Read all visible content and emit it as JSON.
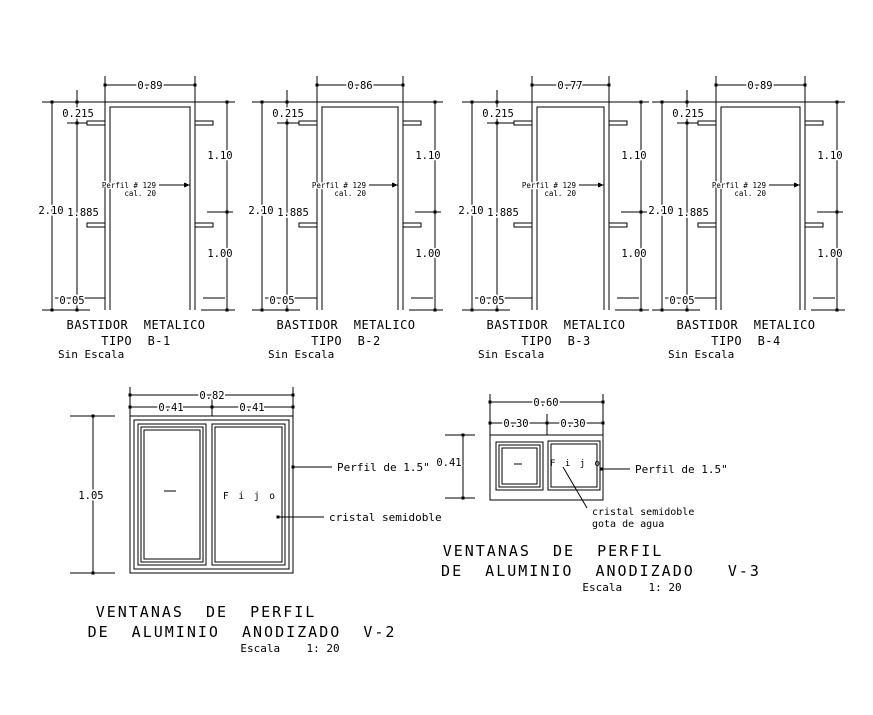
{
  "page": {
    "background": "#ffffff",
    "line_color": "#000000"
  },
  "frames": [
    {
      "top": "0.89",
      "left_offset": "0.215",
      "total_height": "2.10",
      "inner_height": "1.885",
      "floor": "0.05",
      "right_upper": "1.10",
      "right_lower": "1.00",
      "profile_1": "Perfil # 129",
      "profile_2": "cal. 20",
      "title_1": "BASTIDOR  METALICO",
      "title_2": "TIPO  B-1",
      "note": "Sin Escala"
    },
    {
      "top": "0.86",
      "left_offset": "0.215",
      "total_height": "2.10",
      "inner_height": "1.885",
      "floor": "0.05",
      "right_upper": "1.10",
      "right_lower": "1.00",
      "profile_1": "Perfil # 129",
      "profile_2": "cal. 20",
      "title_1": "BASTIDOR  METALICO",
      "title_2": "TIPO  B-2",
      "note": "Sin Escala"
    },
    {
      "top": "0.77",
      "left_offset": "0.215",
      "total_height": "2.10",
      "inner_height": "1.885",
      "floor": "0.05",
      "right_upper": "1.10",
      "right_lower": "1.00",
      "profile_1": "Perfil # 129",
      "profile_2": "cal. 20",
      "title_1": "BASTIDOR  METALICO",
      "title_2": "TIPO  B-3",
      "note": "Sin Escala"
    },
    {
      "top": "0.89",
      "left_offset": "0.215",
      "total_height": "2.10",
      "inner_height": "1.885",
      "floor": "0.05",
      "right_upper": "1.10",
      "right_lower": "1.00",
      "profile_1": "Perfil # 129",
      "profile_2": "cal. 20",
      "title_1": "BASTIDOR  METALICO",
      "title_2": "TIPO  B-4",
      "note": "Sin Escala"
    }
  ],
  "windows": {
    "v2": {
      "total": "0.82",
      "left_half": "0.41",
      "right_half": "0.41",
      "height": "1.05",
      "fixed_label": "F i j o",
      "callout_profile": "Perfil de 1.5\"",
      "callout_glass": "cristal semidoble",
      "title_1": "VENTANAS  DE  PERFIL",
      "title_2": "DE  ALUMINIO  ANODIZADO  V-2",
      "scale": "Escala    1: 20"
    },
    "v3": {
      "total": "0.60",
      "left_half": "0.30",
      "right_half": "0.30",
      "height": "0.41",
      "fixed_label": "F i j o",
      "callout_profile": "Perfil de 1.5\"",
      "callout_glass_1": "cristal semidoble",
      "callout_glass_2": "gota de agua",
      "title_1": "VENTANAS  DE  PERFIL",
      "title_2": "DE  ALUMINIO  ANODIZADO   V-3",
      "scale": "Escala    1: 20"
    }
  }
}
